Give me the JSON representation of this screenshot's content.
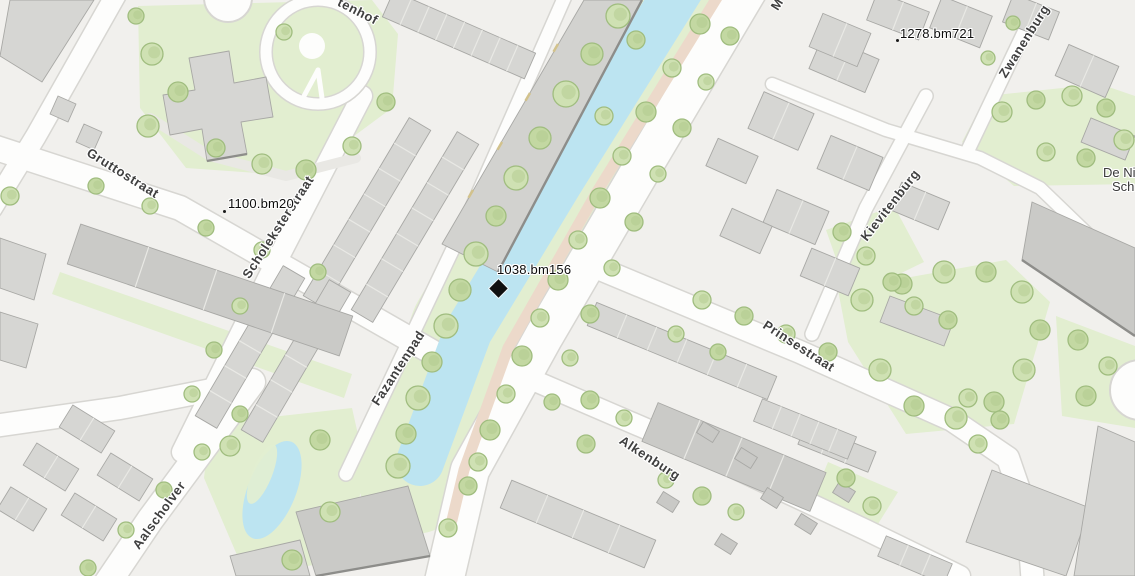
{
  "map": {
    "kind": "topographic-street-map",
    "street_labels": [
      {
        "id": "gruttostraat",
        "text": "Gruttostraat"
      },
      {
        "id": "scholeksterstraat",
        "text": "Scholeksterstraat"
      },
      {
        "id": "fazantenpad",
        "text": "Fazantenpad"
      },
      {
        "id": "aalscholver",
        "text": "Aalscholver"
      },
      {
        "id": "alkenburg",
        "text": "Alkenburg"
      },
      {
        "id": "prinsestraat",
        "text": "Prinsestraat"
      },
      {
        "id": "kievitenburg",
        "text": "Kievitenburg"
      },
      {
        "id": "zwanenburg",
        "text": "Zwanenburg"
      },
      {
        "id": "tenhof",
        "text": "tenhof"
      },
      {
        "id": "m",
        "text": "M"
      }
    ],
    "place_labels": [
      {
        "id": "de-nieuwe",
        "line1": "De Ni",
        "line2": "Sch"
      }
    ],
    "benchmarks": [
      {
        "id": "bm-1100",
        "text": "1100.bm20",
        "marker": "dot"
      },
      {
        "id": "bm-1038",
        "text": "1038.bm156",
        "marker": "black-diamond"
      },
      {
        "id": "bm-1278",
        "text": "1278.bm721",
        "marker": "dot"
      }
    ],
    "colors": {
      "background": "#f1f0ed",
      "road": "#fdfdfc",
      "road_casing": "#d7d6d2",
      "gray_path": "#e9e8e4",
      "grass": "#e2eed0",
      "tree_fill": "#cfe1b3",
      "tree_fill2": "#c3d8a2",
      "tree_stroke": "#a0bd7f",
      "tree_texture": "#afc98b",
      "water": "#bce4f1",
      "path_tan": "#ecd9ca",
      "building": "#d6d6d3",
      "building_dark": "#cacac7",
      "building_stroke": "#a8a8a5",
      "shade_edge": "#8d8d8a",
      "label_color": "#3f3f3f"
    }
  }
}
